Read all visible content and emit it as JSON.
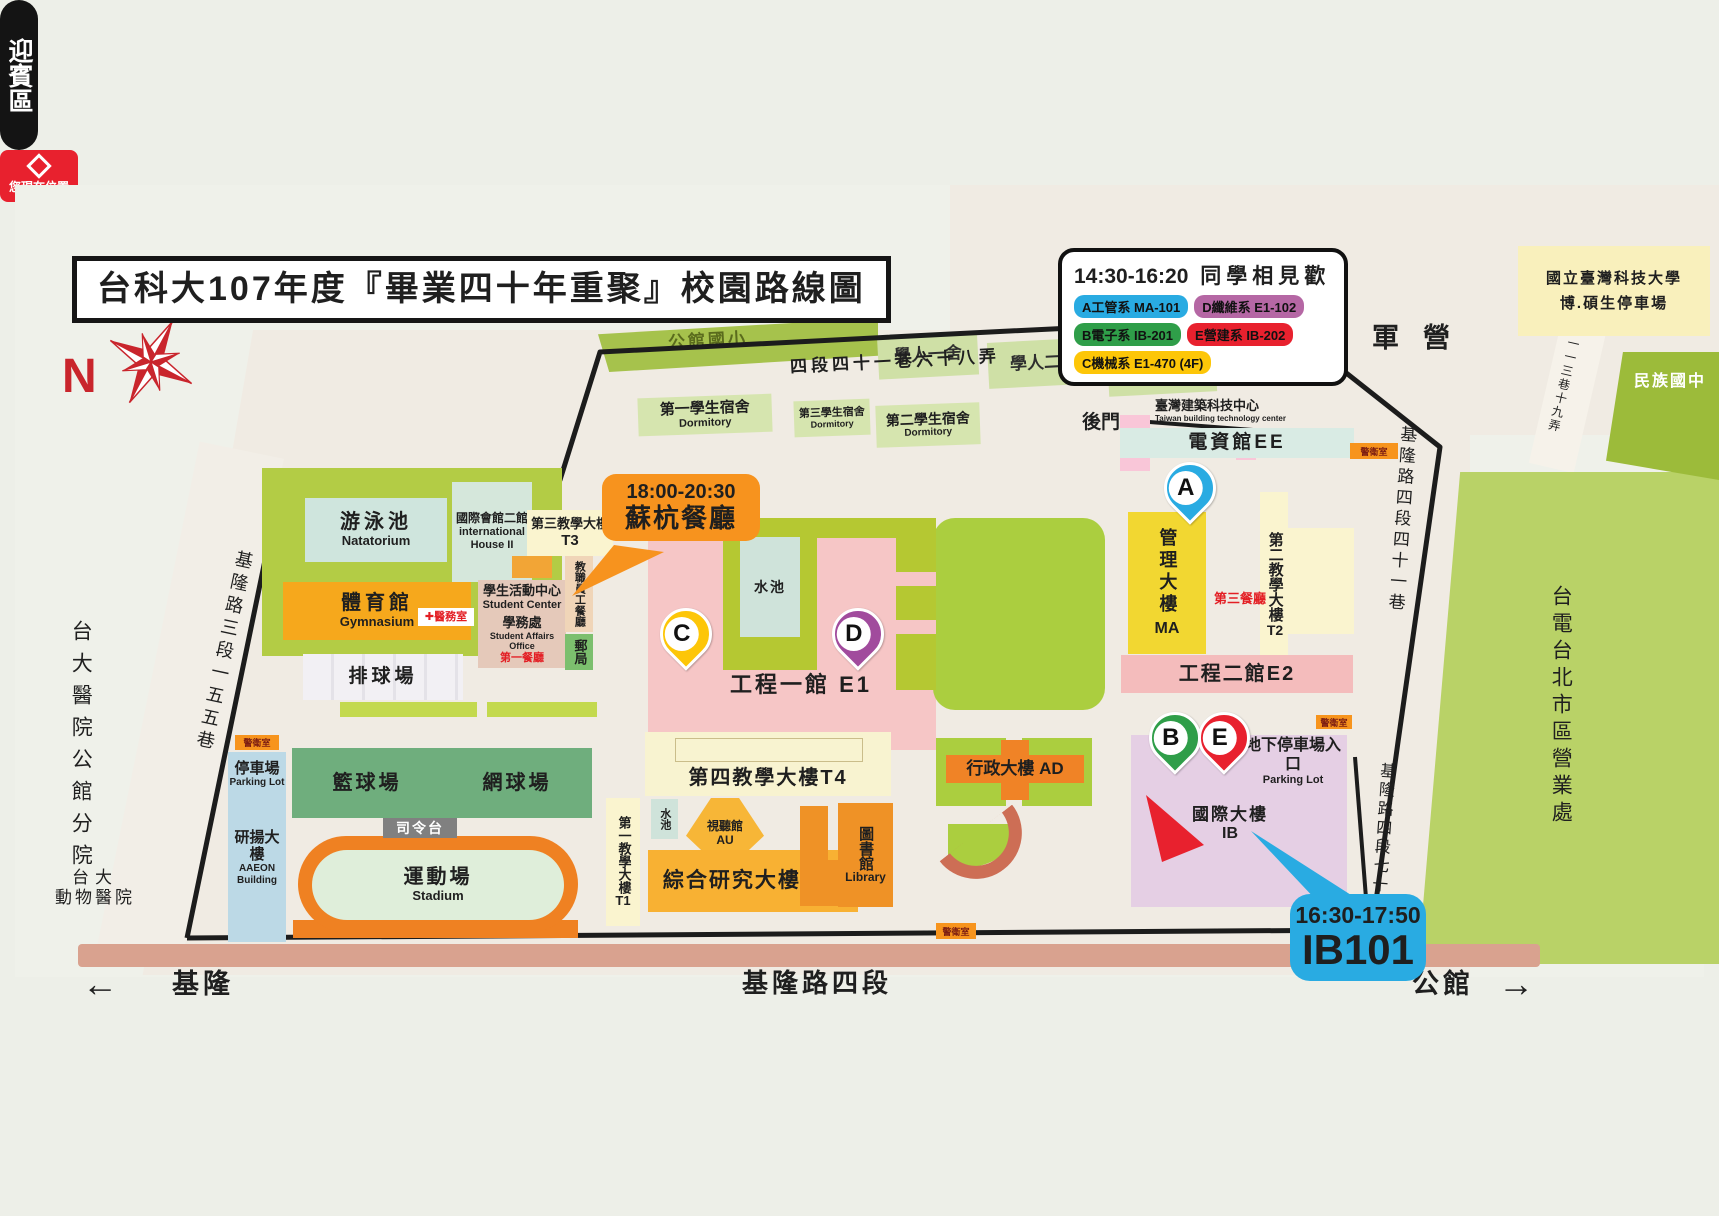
{
  "title": "台科大107年度『畢業四十年重聚』校園路線圖",
  "compass": {
    "n": "N"
  },
  "legend": {
    "time": "14:30-16:20",
    "heading": "同學相見歡",
    "items": [
      {
        "label": "A工管系 MA-101",
        "color": "#29abe2"
      },
      {
        "label": "D纖維系 E1-102",
        "color": "#b567a4"
      },
      {
        "label": "B電子系 IB-201",
        "color": "#2f9e49"
      },
      {
        "label": "E營建系 IB-202",
        "color": "#e8212e"
      },
      {
        "label": "C機械系 E1-470 (4F)",
        "color": "#fdc608"
      }
    ]
  },
  "callouts": {
    "dinner": {
      "time": "18:00-20:30",
      "name": "蘇杭餐廳"
    },
    "ib101": {
      "time": "16:30-17:50",
      "room": "IB101"
    },
    "you_are_here": "您現在位置",
    "welcome": "迎賓區"
  },
  "markers": {
    "a": "A",
    "b": "B",
    "c": "C",
    "d": "D",
    "e": "E"
  },
  "roads": {
    "top_lane": "四段四十一巷六十八弄",
    "keelung_sec3_lane155": "基隆路三段一五五巷",
    "keelung_sec4_lane41": "基隆路四段四十一巷",
    "keelung_sec4_lane70": "基隆路四段七十",
    "lane_113_19": "一一三巷十九弄",
    "bottom_road": "基隆路四段",
    "west_dir": "基隆",
    "east_dir": "公館",
    "west_arrow": "←",
    "east_arrow": "→",
    "back_gate": "後門"
  },
  "places": {
    "army": "軍營",
    "grad_parking": {
      "l1": "國立臺灣科技大學",
      "l2": "博.碩生停車場"
    },
    "minzu": "民族國中",
    "taipower": "台電台北市區營業處",
    "ntu_hospital": "台大醫院公館分院",
    "ntu_vet": {
      "l1": "台大",
      "l2": "動物醫院"
    },
    "gongguan_es": "公館國小",
    "xueren1": "學人一舍",
    "xueren2": "學人二舍",
    "xueren3": "學人",
    "guard": "警衛室"
  },
  "buildings": {
    "dorm1": {
      "zh": "第一學生宿舍",
      "en": "Dormitory"
    },
    "dorm3": {
      "zh": "第三學生宿舍",
      "en": "Dormitory"
    },
    "dorm2": {
      "zh": "第二學生宿舍",
      "en": "Dormitory"
    },
    "tbtc": {
      "zh": "臺灣建築科技中心",
      "en": "Taiwan building technology center"
    },
    "ee": "電資館EE",
    "natatorium": {
      "zh": "游泳池",
      "en": "Natatorium"
    },
    "ih2": {
      "zh": "國際會館二館",
      "en1": "international",
      "en2": "House II"
    },
    "t3": {
      "zh": "第三教學大樓",
      "en": "T3"
    },
    "gym": {
      "zh": "體育館",
      "en": "Gymnasium"
    },
    "clinic": "✚醫務室",
    "student_center": {
      "zh": "學生活動中心",
      "en": "Student Center"
    },
    "student_affairs": {
      "zh": "學務處",
      "en": "Student Affairs Office"
    },
    "cafeteria1": "第一餐廳",
    "staff_restaurant": "教職員工餐廳",
    "post": "郵局",
    "volleyball": "排球場",
    "basketball": "籃球場",
    "tennis": "網球場",
    "podium": "司令台",
    "stadium": {
      "zh": "運動場",
      "en": "Stadium"
    },
    "parking_w": {
      "zh": "停車場",
      "en": "Parking Lot"
    },
    "aaeon": {
      "zh": "研揚大樓",
      "en1": "AAEON",
      "en2": "Building"
    },
    "e1": "工程一館 E1",
    "pool": "水池",
    "t1": {
      "zh": "第一教學大樓",
      "en": "T1"
    },
    "t4": "第四教學大樓T4",
    "au": {
      "zh": "視聽館",
      "en": "AU"
    },
    "rb": "綜合研究大樓 RB",
    "library": {
      "zh": "圖書館",
      "en": "Library"
    },
    "ad": "行政大樓 AD",
    "ma": {
      "zh": "管理大樓",
      "en": "MA"
    },
    "cafeteria3": "第三餐廳",
    "t2": {
      "zh": "第二教學大樓",
      "en": "T2"
    },
    "e2": "工程二館E2",
    "ug_parking": {
      "zh": "地下停車場入口",
      "en": "Parking Lot"
    },
    "ib": {
      "zh": "國際大樓",
      "en": "IB"
    }
  }
}
